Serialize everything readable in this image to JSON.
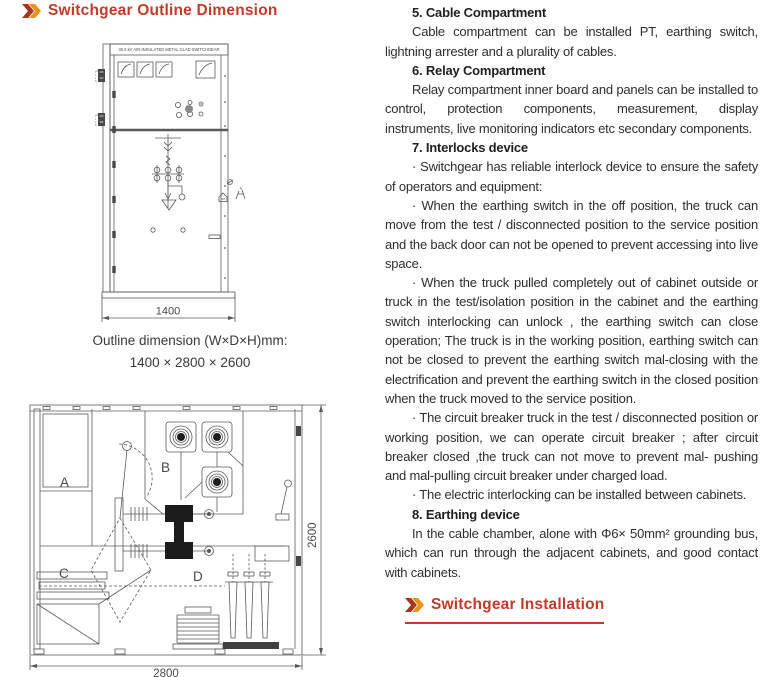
{
  "colors": {
    "heading_red": "#c23b2b",
    "arrow_dark_red": "#a6341f",
    "arrow_orange": "#e79317",
    "drawing_line_gray": "#5a5a5a",
    "body_text": "#2e2e2e"
  },
  "left": {
    "heading": "Switchgear Outline Dimension",
    "front_view": {
      "nameplate": "40.5 kV AIR-INSULATED METAL CLAD SWITCHGEAR",
      "width_dim": "1400"
    },
    "caption": {
      "line1": "Outline dimension (W×D×H)mm:",
      "line2": "1400 × 2800 × 2600"
    },
    "section_view": {
      "label_a": "A",
      "label_b": "B",
      "label_c": "C",
      "label_d": "D",
      "depth_dim": "2800",
      "height_dim": "2600"
    }
  },
  "right": {
    "sections": [
      {
        "heading": "5. Cable Compartment",
        "paragraphs": [
          "Cable compartment can be installed PT, earthing switch, lightning arrester and a plurality of cables."
        ]
      },
      {
        "heading": "6. Relay Compartment",
        "paragraphs": [
          "Relay compartment inner board and panels can be installed to control, protection components, measurement, display instruments, live monitoring indicators etc secondary components."
        ]
      },
      {
        "heading": "7. Interlocks device",
        "paragraphs": [
          "· Switchgear has reliable interlock device to ensure the safety of operators and equipment:",
          "· When the earthing switch in the off position, the truck can move from the test / disconnected position to the service position and the back door can not be opened to prevent accessing into live space.",
          "· When the truck pulled completely out of cabinet outside  or truck in the test/isolation position in the cabinet and the earthing switch interlocking can unlock , the earthing switch can close operation; The truck is in the working position, earthing switch can not be closed to prevent  the earthing switch mal-closing with the electrification and prevent the earthing switch in the closed position when the truck moved to the service position.",
          "· The circuit breaker truck in the test / disconnected position or working position, we can operate circuit breaker ; after circuit breaker closed ,the truck can not move to prevent mal- pushing and mal-pulling circuit breaker under charged load.",
          "· The electric interlocking can be installed between cabinets."
        ]
      },
      {
        "heading": "8. Earthing device",
        "paragraphs": [
          "In the cable chamber, alone with Φ6× 50mm² grounding bus, which can run through the adjacent cabinets, and good contact with cabinets."
        ]
      }
    ],
    "footer_heading": "Switchgear Installation"
  }
}
